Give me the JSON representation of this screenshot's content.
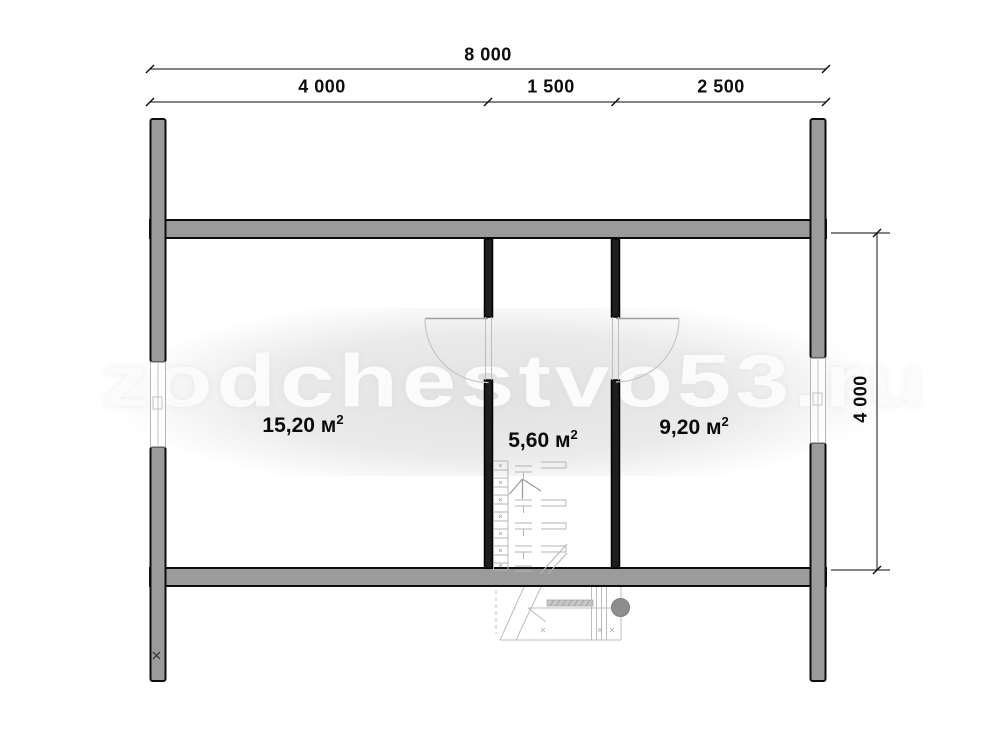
{
  "watermark": {
    "text": "zodchestvo53.ru"
  },
  "dimensions": {
    "top_total": {
      "label": "8 000"
    },
    "top_segments": [
      {
        "label": "4 000"
      },
      {
        "label": "1 500"
      },
      {
        "label": "2 500"
      }
    ],
    "right_height": {
      "label": "4 000"
    }
  },
  "rooms": [
    {
      "name": "left-room",
      "area_label": "15,20 м",
      "sup": "2"
    },
    {
      "name": "middle-room",
      "area_label": "5,60 м",
      "sup": "2"
    },
    {
      "name": "right-room",
      "area_label": "9,20 м",
      "sup": "2"
    }
  ],
  "colors": {
    "background": "#ffffff",
    "wall_fill": "#9b9b9b",
    "wall_outline": "#0d0d0d",
    "partition_fill": "#1e1e1e",
    "watermark_wash": "#e4e4e4",
    "watermark_text": "#fbfbfb",
    "detail_line": "#bcbcbc",
    "porch_circle": "#8d8d8d",
    "dimension_line": "#333333",
    "label_text": "#0d0d0d"
  }
}
